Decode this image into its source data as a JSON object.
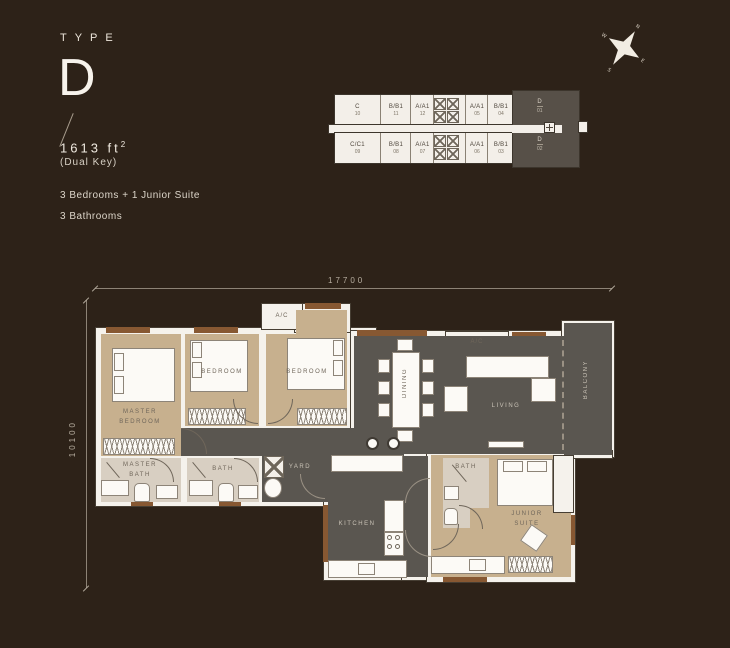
{
  "header": {
    "type_label": "TYPE",
    "type_letter": "D",
    "area": "1613",
    "area_unit": "ft",
    "area_exp": "2",
    "key_note": "(Dual Key)",
    "feature_1": "3 Bedrooms + 1 Junior Suite",
    "feature_2": "3 Bathrooms"
  },
  "compass": {
    "north": "N",
    "east": "E",
    "south": "S",
    "west": "W"
  },
  "dimensions": {
    "width_mm": "17700",
    "height_mm": "10100"
  },
  "key_plan": {
    "top_units": [
      {
        "label": "C",
        "no": "10"
      },
      {
        "label": "B/B1",
        "no": "11"
      },
      {
        "label": "A/A1",
        "no": "12"
      },
      {
        "label": "A/A1",
        "no": "05"
      },
      {
        "label": "B/B1",
        "no": "04"
      }
    ],
    "bottom_units": [
      {
        "label": "C/C1",
        "no": "09"
      },
      {
        "label": "B/B1",
        "no": "08"
      },
      {
        "label": "A/A1",
        "no": "07"
      },
      {
        "label": "A/A1",
        "no": "06"
      },
      {
        "label": "B/B1",
        "no": "03"
      }
    ],
    "d_top": {
      "label": "D",
      "no": "01"
    },
    "d_bottom": {
      "label": "D",
      "no": "02"
    }
  },
  "rooms": {
    "master_bedroom": "MASTER\nBEDROOM",
    "bedroom_2": "BEDROOM",
    "bedroom_3": "BEDROOM",
    "master_bath": "MASTER\nBATH",
    "bath": "BATH",
    "yard": "YARD",
    "kitchen": "KITCHEN",
    "dining": "DINING",
    "living": "LIVING",
    "balcony": "BALCONY",
    "suite_bath": "BATH",
    "junior_suite": "JUNIOR\nSUITE",
    "ac_1": "A/C",
    "ac_2": "A/C"
  },
  "colors": {
    "background": "#2d2218",
    "wall_white": "#f5f2ec",
    "floor_bedroom": "#c7b08e",
    "floor_bath": "#d8cfc2",
    "floor_gray": "#5a5650",
    "wood_accent": "#875832",
    "keyplan_highlight": "#575048"
  }
}
